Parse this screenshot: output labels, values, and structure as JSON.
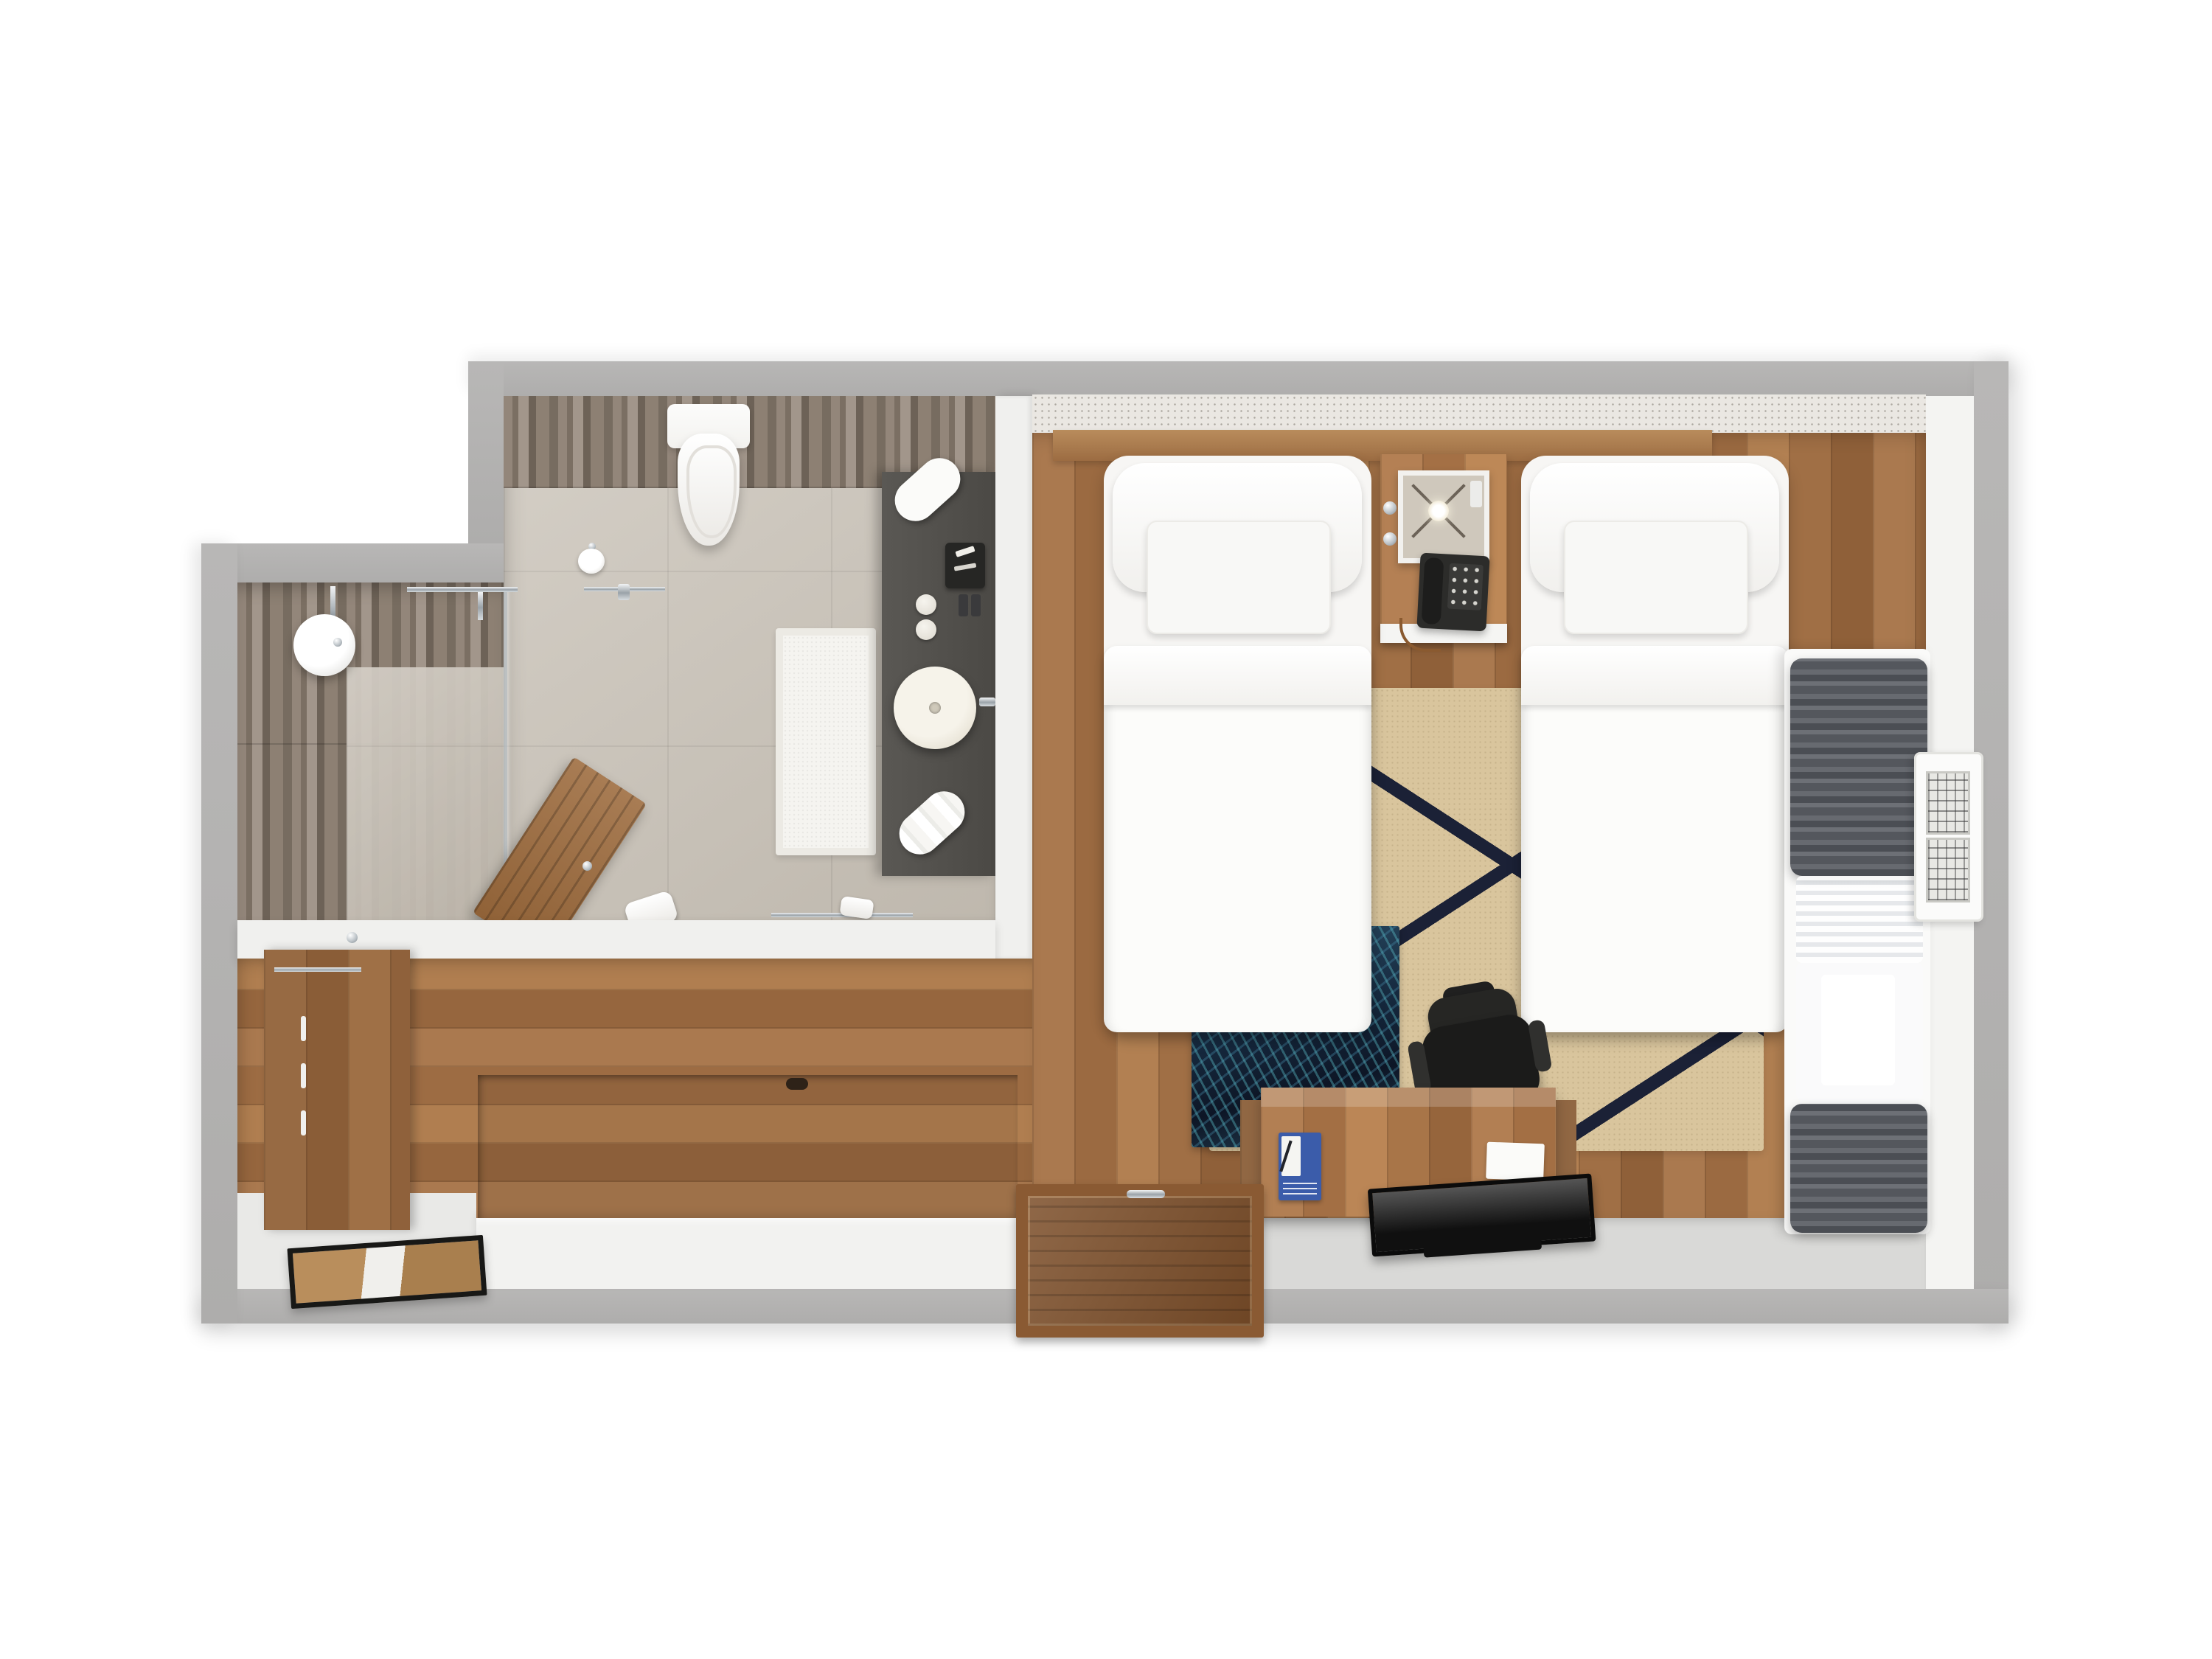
{
  "scene": {
    "type": "3d-floor-plan-render",
    "view": "top-down",
    "subject": "hotel twin guest room with en-suite bathroom and entry hall"
  },
  "palette": {
    "background": "#ffffff",
    "outer_wall_gray": "#b3b2b1",
    "inner_wall_white": "#f2f2f0",
    "wood_floor": "#a5744a",
    "wood_tile_bath_wall": "#87796c",
    "bath_tile_floor": "#c9c2b7",
    "vanity_counter_dark": "#514f4b",
    "rug_base": "#d9c59d",
    "rug_stripe_navy": "#1b2136",
    "runner_navy": "#142236",
    "runner_teal_accent": "#3f93a0",
    "bedding_white": "#f9f8f6",
    "curtain_gray": "#595c62",
    "chair_black": "#23231f",
    "tv_black": "#111111",
    "door_wood": "#8a5a33",
    "menu_card_blue": "#3b5caa"
  },
  "rooms": {
    "bedroom": {
      "name": "bedroom",
      "furniture": [
        "twin-bed-left",
        "twin-bed-right",
        "nightstand",
        "table-lamp",
        "telephone",
        "wall-knobs",
        "area-rug",
        "bed-runner-art",
        "desk",
        "desk-chair",
        "television",
        "menu-card",
        "notepad",
        "window-sill-console",
        "curtain-top",
        "sheer-curtain",
        "curtain-bottom",
        "ptac-air-conditioner",
        "entry-door"
      ]
    },
    "bathroom": {
      "name": "bathroom",
      "furniture": [
        "rain-shower-head",
        "shower-mixer-bar",
        "glass-screen",
        "wall-hung-toilet",
        "toilet-paper-holder",
        "bath-mat",
        "vanity-counter",
        "vessel-sink",
        "faucet",
        "amenity-tray",
        "soap-dishes",
        "toiletry-bottles",
        "rolled-towel-top",
        "rolled-towel-bottom",
        "wooden-door-leaf",
        "floor-towel",
        "towel-rail"
      ]
    },
    "entry": {
      "name": "entry-hall",
      "furniture": [
        "wardrobe-minibar-cabinet",
        "coat-hook",
        "hanging-rail",
        "drawer-handles",
        "raised-floor-platform",
        "leaning-mirror",
        "vestibule-wall"
      ]
    }
  },
  "counts": {
    "beds": 2,
    "pillows_per_bed": 2,
    "curtain_bunches": 2,
    "wardrobe_drawers": 3,
    "soap_dishes": 2
  }
}
